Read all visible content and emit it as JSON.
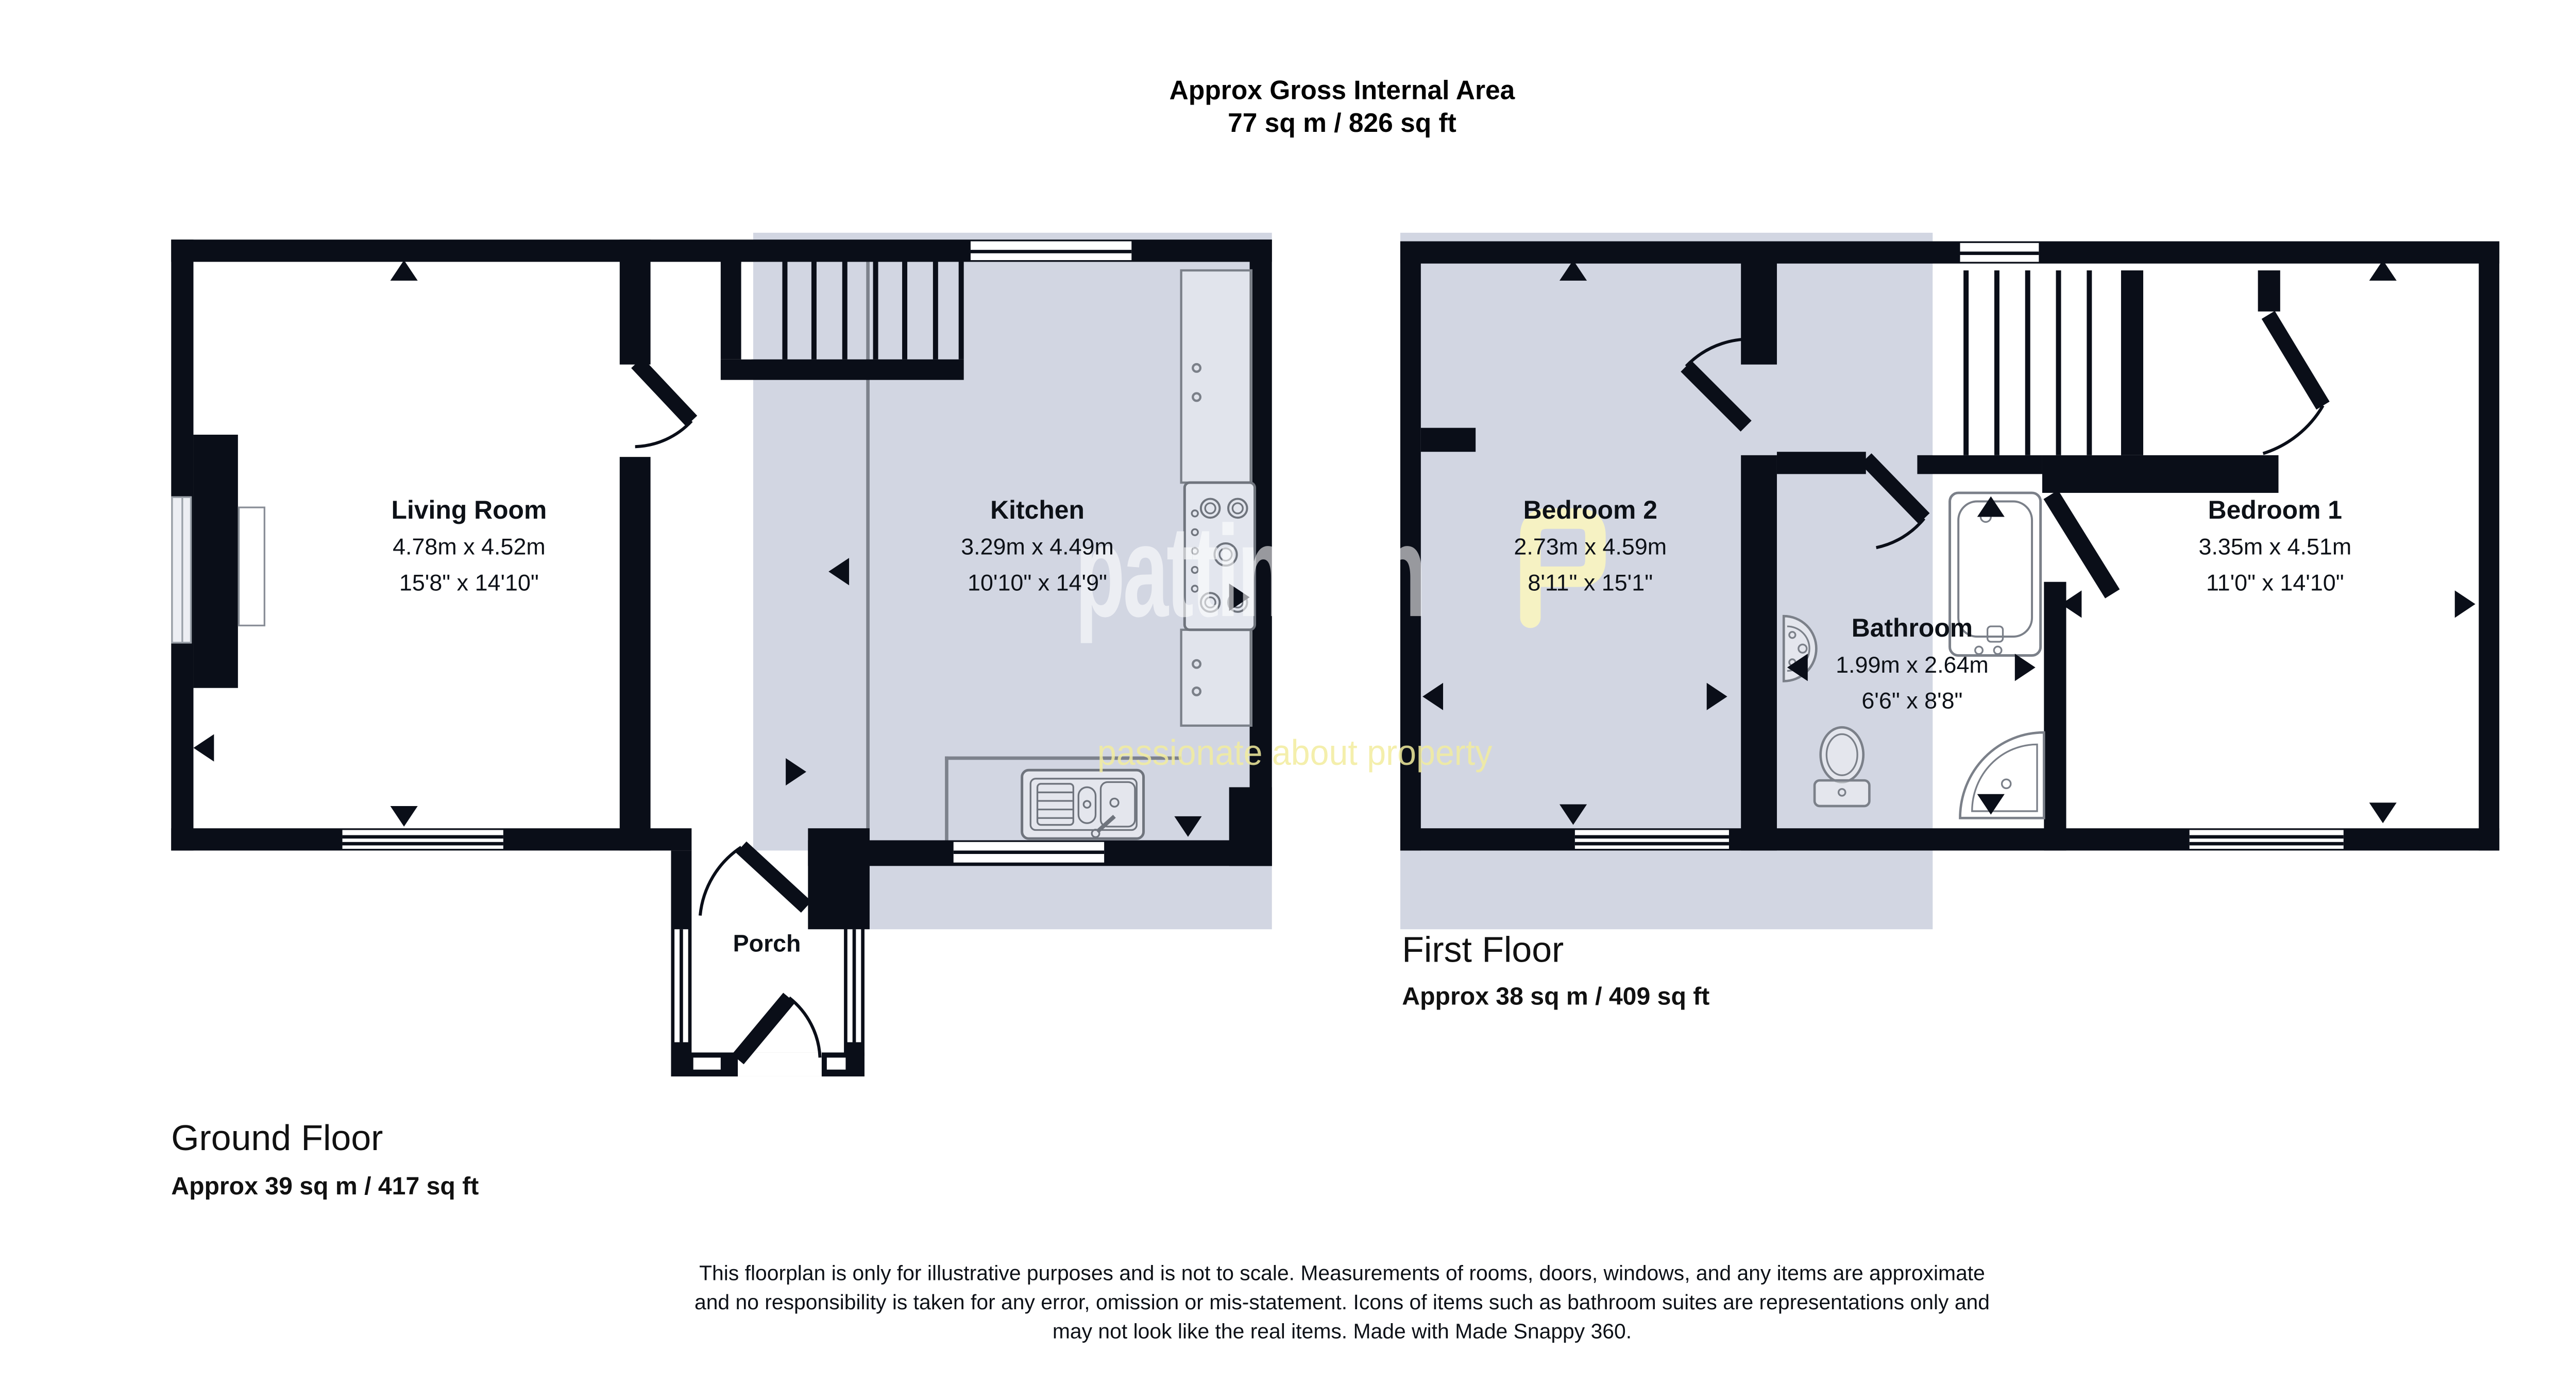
{
  "header": {
    "line1": "Approx Gross Internal Area",
    "line2": "77 sq m / 826 sq ft"
  },
  "floors": {
    "ground": {
      "title": "Ground Floor",
      "area": "Approx 39 sq m / 417 sq ft"
    },
    "first": {
      "title": "First Floor",
      "area": "Approx 38 sq m / 409 sq ft"
    }
  },
  "rooms": {
    "living_room": {
      "name": "Living Room",
      "metric": "4.78m x 4.52m",
      "imperial": "15'8\" x 14'10\""
    },
    "kitchen": {
      "name": "Kitchen",
      "metric": "3.29m x 4.49m",
      "imperial": "10'10\" x 14'9\""
    },
    "bedroom2": {
      "name": "Bedroom 2",
      "metric": "2.73m x 4.59m",
      "imperial": "8'11\" x 15'1\""
    },
    "bathroom": {
      "name": "Bathroom",
      "metric": "1.99m x 2.64m",
      "imperial": "6'6\" x 8'8\""
    },
    "bedroom1": {
      "name": "Bedroom 1",
      "metric": "3.35m x 4.51m",
      "imperial": "11'0\" x 14'10\""
    },
    "porch": {
      "name": "Porch"
    }
  },
  "watermark": {
    "brand": "pattinson",
    "tagline": "passionate about property"
  },
  "disclaimer": [
    "This floorplan is only for illustrative purposes and is not to scale. Measurements of rooms, doors, windows, and any items are approximate",
    "and no responsibility is taken for any error, omission or mis-statement. Icons of items such as bathroom suites are representations only and",
    "may not look like the real items. Made with Made Snappy 360."
  ],
  "colors": {
    "wall": "#0a0e18",
    "highlight_shade": "#d2d6e2",
    "brand_yellow": "#f4eea2",
    "fixture_outline": "#7b8089"
  }
}
